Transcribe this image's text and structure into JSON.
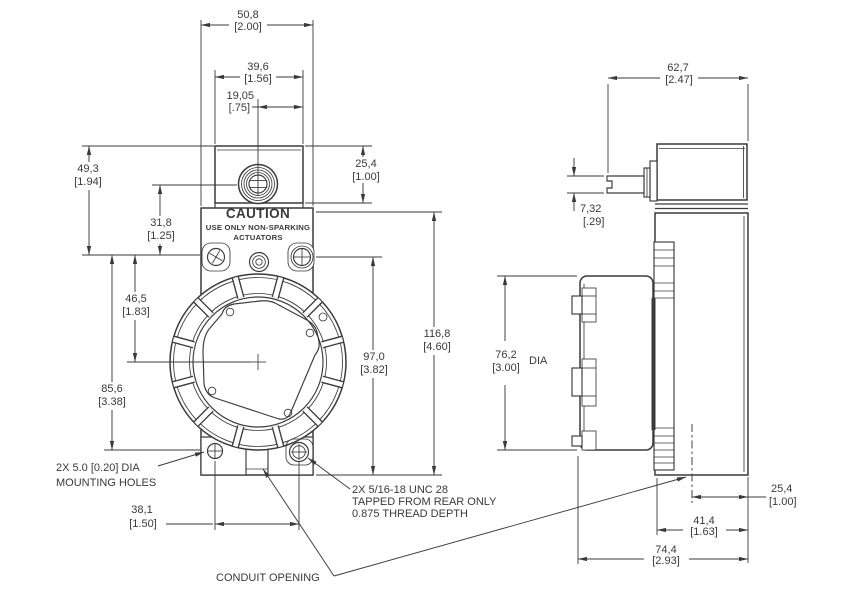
{
  "drawing": {
    "caution": {
      "title": "CAUTION",
      "line1": "USE ONLY NON-SPARKING",
      "line2": "ACTUATORS"
    },
    "front": {
      "overall_width": {
        "mm": "50,8",
        "in": "[2.00]"
      },
      "head_width": {
        "mm": "39,6",
        "in": "[1.56]"
      },
      "center_to_edge": {
        "mm": "19,05",
        "in": "[.75]"
      },
      "head_height": {
        "mm": "25,4",
        "in": "[1.00]"
      },
      "top_to_mount_face": {
        "mm": "49,3",
        "in": "[1.94]"
      },
      "shaft_to_mount_face": {
        "mm": "31,8",
        "in": "[1.25]"
      },
      "mount_face_to_center": {
        "mm": "46,5",
        "in": "[1.83]"
      },
      "mount_face_to_holes": {
        "mm": "85,6",
        "in": "[3.38]"
      },
      "body_height": {
        "mm": "97,0",
        "in": "[3.82]"
      },
      "overall_height": {
        "mm": "116,8",
        "in": "[4.60]"
      },
      "hole_spacing": {
        "mm": "38,1",
        "in": "[1.50]"
      }
    },
    "side": {
      "overall_depth": {
        "mm": "62,7",
        "in": "[2.47]"
      },
      "shaft_thickness": {
        "mm": "7,32",
        "in": "[.29]"
      },
      "cover_diameter": {
        "mm": "76,2",
        "in": "[3.00]",
        "suffix": "DIA"
      },
      "conduit_to_rear": {
        "mm": "25,4",
        "in": "[1.00]"
      },
      "body_depth": {
        "mm": "41,4",
        "in": "[1.63]"
      },
      "overall_depth_bottom": {
        "mm": "74,4",
        "in": "[2.93]"
      }
    },
    "notes": {
      "mounting_holes": [
        "2X 5.0 [0.20] DIA",
        "MOUNTING HOLES"
      ],
      "tapped_holes": [
        "2X 5/16-18 UNC 28",
        "TAPPED FROM REAR ONLY",
        "0.875 THREAD DEPTH"
      ],
      "conduit": "CONDUIT OPENING"
    },
    "colors": {
      "line": "#3a3a3a",
      "background": "#ffffff"
    }
  }
}
